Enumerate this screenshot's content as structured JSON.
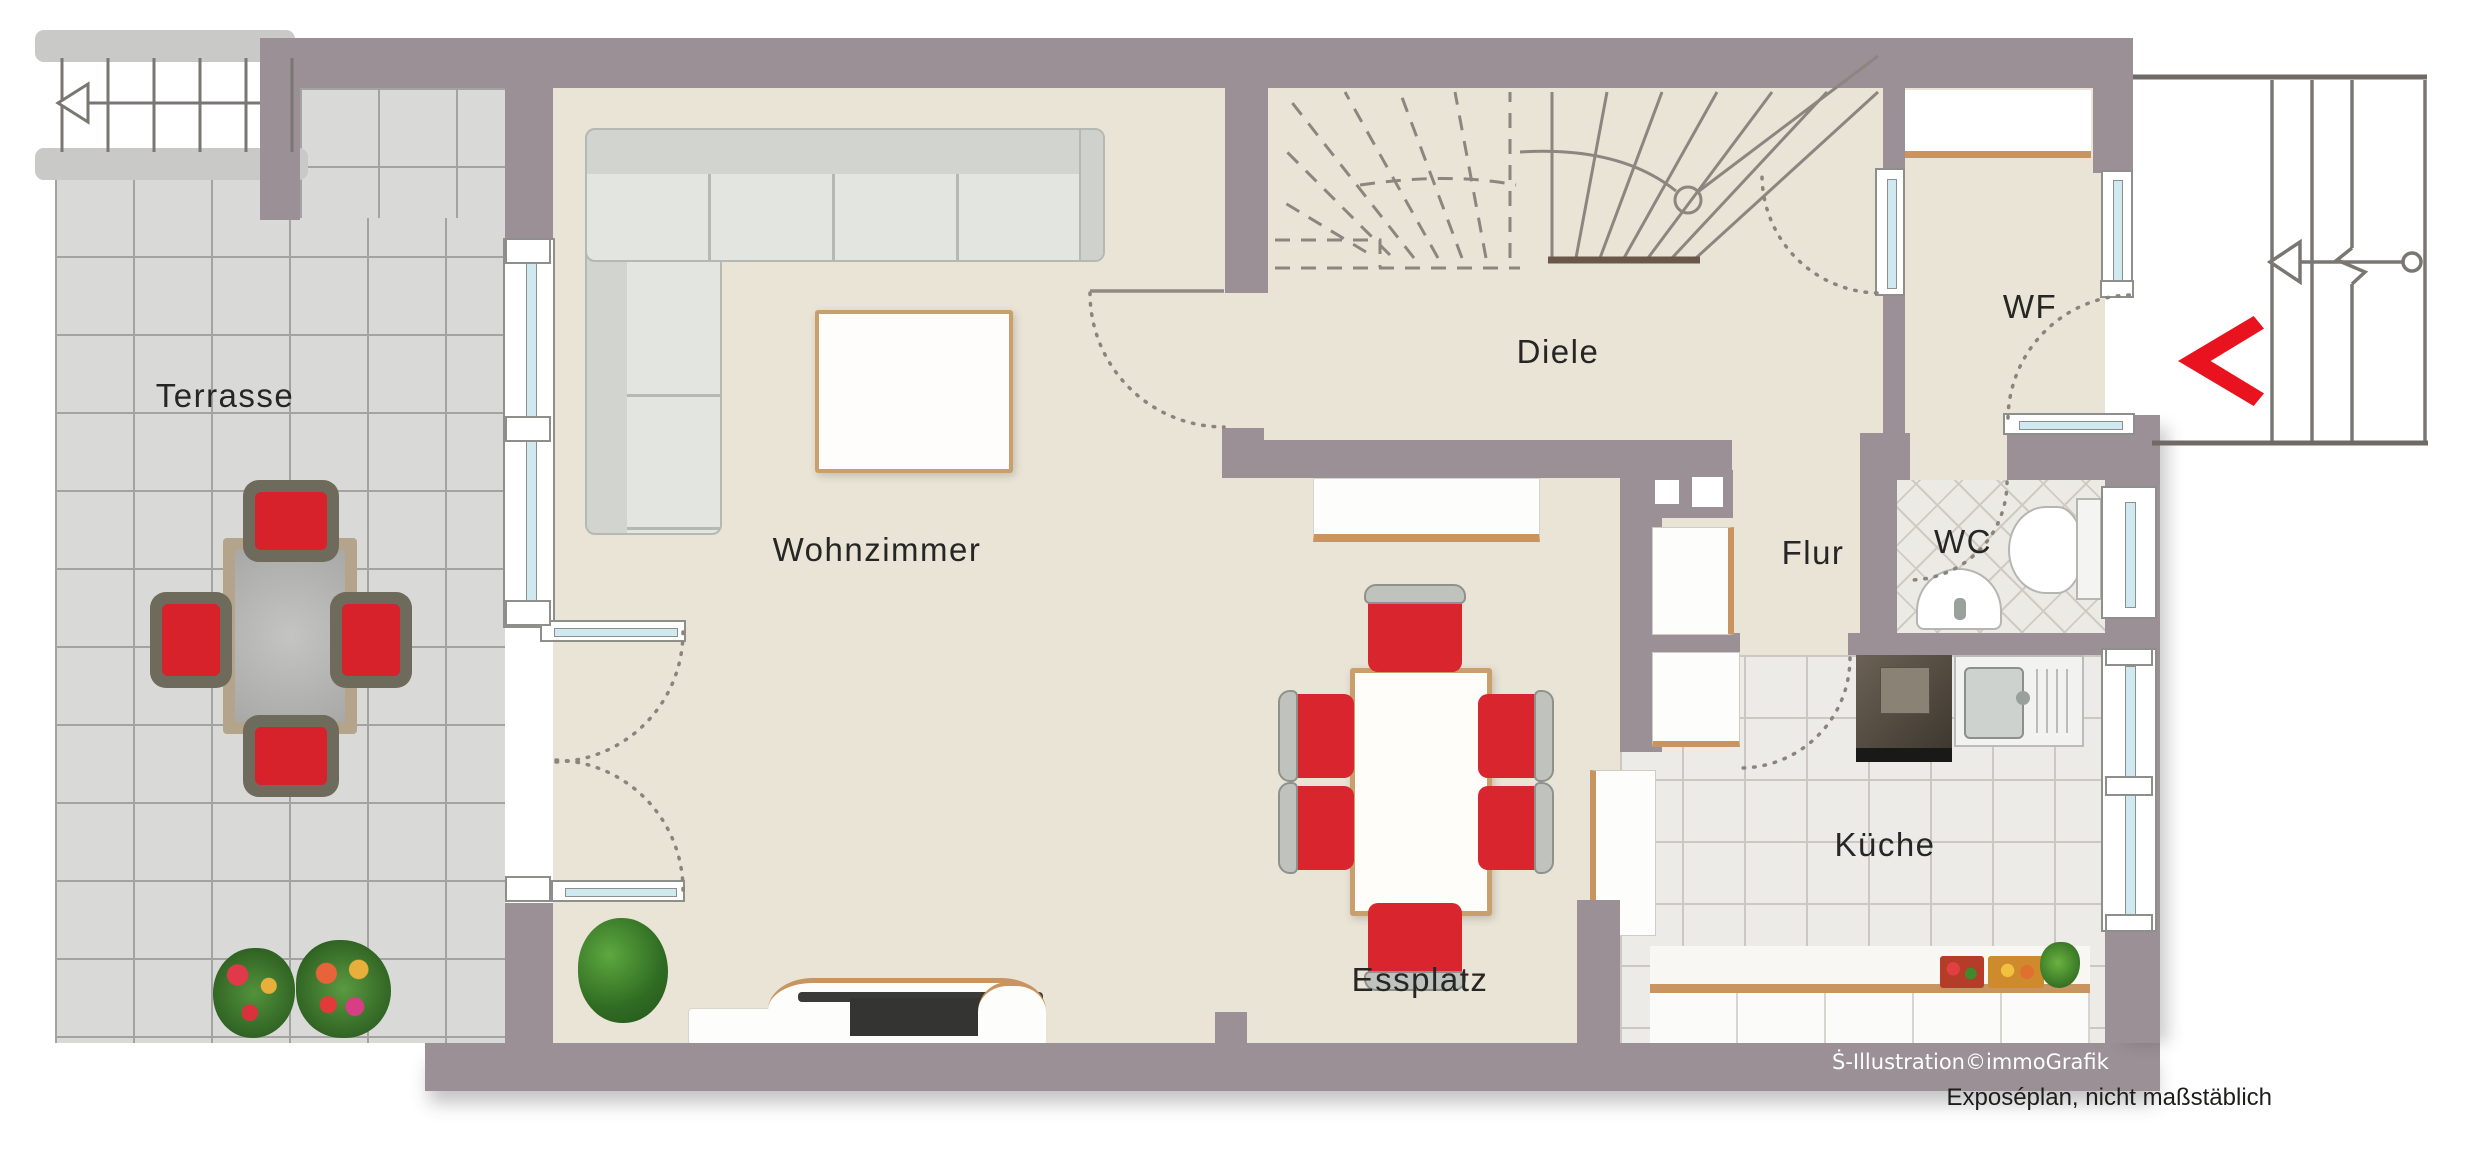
{
  "plan_title": "Erdgeschoss Grundriss",
  "rooms": {
    "terrasse": {
      "label": "Terrasse"
    },
    "wohnzimmer": {
      "label": "Wohnzimmer"
    },
    "diele": {
      "label": "Diele"
    },
    "wf": {
      "label": "WF"
    },
    "flur": {
      "label": "Flur"
    },
    "wc": {
      "label": "WC"
    },
    "kueche": {
      "label": "Küche"
    },
    "essplatz": {
      "label": "Essplatz"
    }
  },
  "credits": {
    "watermark": "Ṡ-Illustration©immoGrafik",
    "caption": "Exposéplan, nicht maßstäblich"
  },
  "colors": {
    "wall": "#9a9095",
    "interior_floor": "#e9e4d6",
    "terrace_tile": "#d9d9d7",
    "kitchen_tile": "#edebe7",
    "window_glass": "#cfe9f1",
    "entrance_arrow_red": "#e8131f",
    "chair_red": "#d8252e",
    "wood_trim": "#c8945f",
    "plant_green": "#3f7d2c"
  },
  "icons": {
    "entrance_arrow": "red-chevron-left",
    "stair_direction": "outline-triangle-arrow-left"
  }
}
